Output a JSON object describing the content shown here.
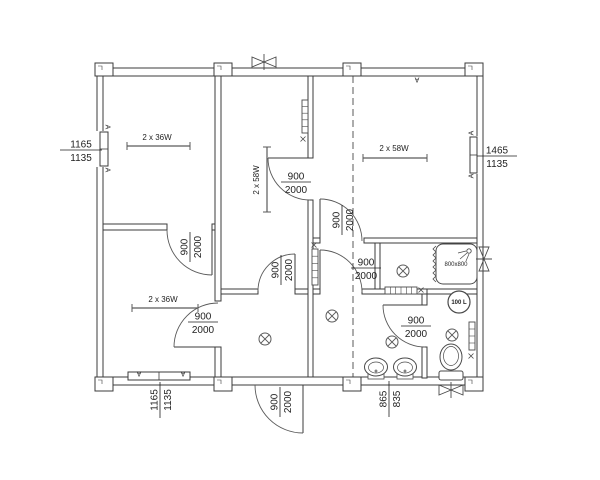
{
  "title": "Modular container house floor plan",
  "colors": {
    "wall": "#3b3b3b",
    "thin": "#5a5a5a",
    "fixture": "#4a4a4a",
    "text": "#1f1f1f",
    "bg": "#ffffff"
  },
  "door_labels": [
    {
      "num": "900",
      "den": "2000",
      "x": 203,
      "y": 322,
      "rot": 0
    },
    {
      "num": "900",
      "den": "2000",
      "x": 190,
      "y": 247,
      "rot": -90
    },
    {
      "num": "900",
      "den": "2000",
      "x": 281,
      "y": 270,
      "rot": -90
    },
    {
      "num": "900",
      "den": "2000",
      "x": 296,
      "y": 182,
      "rot": 0
    },
    {
      "num": "900",
      "den": "2000",
      "x": 342,
      "y": 220,
      "rot": -90
    },
    {
      "num": "900",
      "den": "2000",
      "x": 366,
      "y": 268,
      "rot": 0
    },
    {
      "num": "900",
      "den": "2000",
      "x": 416,
      "y": 326,
      "rot": 0
    },
    {
      "num": "900",
      "den": "2000",
      "x": 280,
      "y": 402,
      "rot": -90
    }
  ],
  "dimension_labels": [
    {
      "num": "1165",
      "den": "1135",
      "x": 81,
      "y": 150,
      "rot": 0,
      "half": 21
    },
    {
      "num": "1465",
      "den": "1135",
      "x": 497,
      "y": 156,
      "rot": 0,
      "half": 20
    },
    {
      "num": "1165",
      "den": "1135",
      "x": 160,
      "y": 400,
      "rot": -90,
      "half": 18
    },
    {
      "num": "865",
      "den": "835",
      "x": 389,
      "y": 399,
      "rot": -90,
      "half": 18
    }
  ],
  "light_labels": [
    {
      "text": "2 x 36W",
      "x": 157,
      "y": 140,
      "rot": 0
    },
    {
      "text": "2 x 36W",
      "x": 163,
      "y": 302,
      "rot": 0
    },
    {
      "text": "2 x 58W",
      "x": 259,
      "y": 180,
      "rot": -90
    },
    {
      "text": "2 x 58W",
      "x": 394,
      "y": 151,
      "rot": 0
    }
  ],
  "fixture_labels": [
    {
      "id": "shower-size",
      "text": "800x800",
      "x": 456,
      "y": 266,
      "size": 6,
      "bold": false
    },
    {
      "id": "boiler-volume",
      "text": "100 L",
      "x": 459,
      "y": 304,
      "size": 6,
      "bold": true
    }
  ],
  "markers": [
    {
      "text": "A",
      "x": 417,
      "y": 80,
      "rot": 180
    },
    {
      "text": "A",
      "x": 108,
      "y": 127,
      "rot": 90
    },
    {
      "text": "A",
      "x": 108,
      "y": 170,
      "rot": 90
    },
    {
      "text": "A",
      "x": 139,
      "y": 374,
      "rot": 180
    },
    {
      "text": "A",
      "x": 183,
      "y": 374,
      "rot": 180
    },
    {
      "text": "A",
      "x": 471,
      "y": 133,
      "rot": -90
    },
    {
      "text": "A",
      "x": 471,
      "y": 176,
      "rot": -90
    }
  ]
}
